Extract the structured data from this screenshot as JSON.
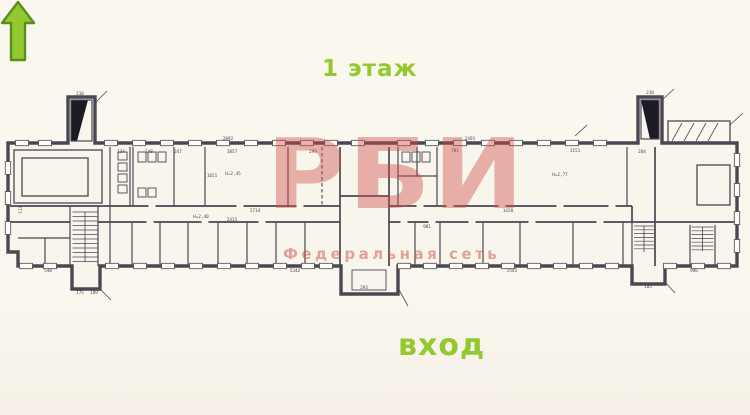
{
  "colors": {
    "background": "#faf7ee",
    "plan_line": "#4a4753",
    "accent_green": "#94c830",
    "arrow_outline": "#568f1d",
    "watermark_red": "#ce4d48"
  },
  "labels": {
    "floor_title": "1 этаж",
    "entrance": "вход"
  },
  "watermark": {
    "main": "РБИ",
    "sub": "Федеральная сеть"
  },
  "plan": {
    "dimensions": [
      {
        "x": 228,
        "y": 140,
        "t": "2892"
      },
      {
        "x": 80,
        "y": 95,
        "t": "210"
      },
      {
        "x": 650,
        "y": 94,
        "t": "210"
      },
      {
        "x": 232,
        "y": 153,
        "t": "1857"
      },
      {
        "x": 212,
        "y": 177,
        "t": "1651"
      },
      {
        "x": 313,
        "y": 153,
        "t": "299"
      },
      {
        "x": 470,
        "y": 140,
        "t": "2491"
      },
      {
        "x": 455,
        "y": 152,
        "t": "781"
      },
      {
        "x": 575,
        "y": 152,
        "t": "1151"
      },
      {
        "x": 642,
        "y": 153,
        "t": "204"
      },
      {
        "x": 508,
        "y": 212,
        "t": "1428"
      },
      {
        "x": 512,
        "y": 272,
        "t": "2545"
      },
      {
        "x": 694,
        "y": 272,
        "t": "946"
      },
      {
        "x": 295,
        "y": 272,
        "t": "5342"
      },
      {
        "x": 48,
        "y": 272,
        "t": "540"
      },
      {
        "x": 80,
        "y": 294,
        "t": "175"
      },
      {
        "x": 94,
        "y": 294,
        "t": "189"
      },
      {
        "x": 364,
        "y": 289,
        "t": "293"
      },
      {
        "x": 648,
        "y": 288,
        "t": "185"
      },
      {
        "x": 255,
        "y": 212,
        "t": "2714"
      },
      {
        "x": 232,
        "y": 221,
        "t": "2415"
      },
      {
        "x": 201,
        "y": 218,
        "t": "Н=2,40"
      },
      {
        "x": 233,
        "y": 175,
        "t": "Н=2,45"
      },
      {
        "x": 560,
        "y": 176,
        "t": "Н=2,77"
      },
      {
        "x": 22,
        "y": 210,
        "t": "113",
        "r": -90
      },
      {
        "x": 121,
        "y": 153,
        "t": "134"
      },
      {
        "x": 149,
        "y": 153,
        "t": "148"
      },
      {
        "x": 178,
        "y": 153,
        "t": "247"
      },
      {
        "x": 427,
        "y": 228,
        "t": "981"
      }
    ],
    "windows": {
      "top": [
        22,
        45,
        111,
        139,
        167,
        195,
        223,
        251,
        279,
        307,
        331,
        358,
        404,
        432,
        460,
        488,
        516,
        544,
        572,
        600
      ],
      "bottom": [
        26,
        50,
        112,
        140,
        168,
        196,
        224,
        252,
        280,
        308,
        326,
        404,
        430,
        456,
        482,
        508,
        534,
        560,
        586,
        612,
        670,
        698,
        724
      ],
      "left": [
        168,
        198,
        228
      ],
      "right": [
        160,
        190,
        218,
        246
      ]
    },
    "doors": {
      "top": [
        152,
        240,
        300,
        420,
        450,
        502,
        560,
        612
      ],
      "bottom": [
        150,
        205,
        262,
        404,
        432,
        472,
        532,
        600
      ]
    },
    "stairs": [
      {
        "x": 72.5,
        "y": 212,
        "w": 25,
        "h": 50,
        "step": 4.5
      },
      {
        "x": 634,
        "y": 226,
        "w": 20,
        "h": 26,
        "step": 3.8
      },
      {
        "x": 691.5,
        "y": 227,
        "w": 22,
        "h": 24,
        "step": 3.8
      }
    ],
    "fixtures": [
      [
        118,
        152,
        9,
        8
      ],
      [
        118,
        163,
        9,
        8
      ],
      [
        118,
        174,
        9,
        8
      ],
      [
        118,
        185,
        9,
        8
      ],
      [
        138,
        152,
        8,
        10
      ],
      [
        148,
        152,
        8,
        10
      ],
      [
        158,
        152,
        8,
        10
      ],
      [
        138,
        188,
        8,
        9
      ],
      [
        148,
        188,
        8,
        9
      ],
      [
        402,
        152,
        8,
        10
      ],
      [
        412,
        152,
        8,
        10
      ],
      [
        422,
        152,
        8,
        10
      ],
      [
        352,
        270,
        34,
        20
      ]
    ],
    "rooms_inner": [
      [
        14,
        150,
        88,
        53
      ],
      [
        22,
        158,
        66,
        38
      ],
      [
        697,
        165,
        33,
        40
      ],
      [
        668,
        121,
        62,
        22
      ]
    ],
    "leaders": [
      [
        95,
        103,
        107,
        91
      ],
      [
        662,
        100,
        674,
        89
      ],
      [
        730,
        125,
        743,
        113
      ],
      [
        398,
        288,
        408,
        306
      ],
      [
        100,
        289,
        111,
        300
      ],
      [
        665,
        282,
        675,
        293
      ],
      [
        575,
        136,
        587,
        125
      ],
      [
        672,
        141,
        682,
        123
      ],
      [
        684,
        141,
        694,
        123
      ],
      [
        696,
        141,
        706,
        123
      ],
      [
        708,
        141,
        718,
        123
      ]
    ]
  }
}
